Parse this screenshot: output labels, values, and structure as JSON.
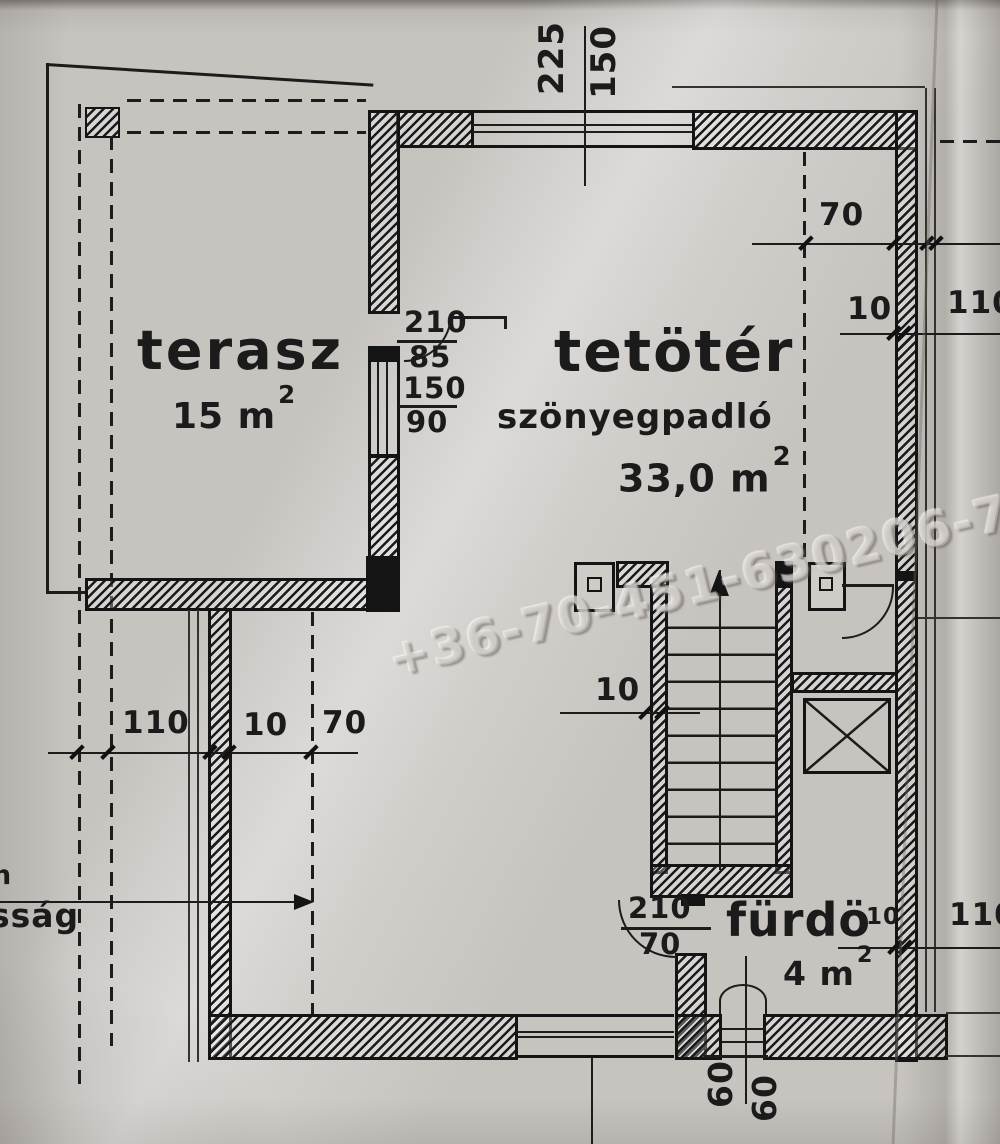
{
  "watermark": {
    "text": "+36-70-451-630206-70-525-3"
  },
  "rooms": {
    "terasz": {
      "name": "terasz",
      "area_value": "15 m",
      "area_sup": "2"
    },
    "tetoter": {
      "name": "tetötér",
      "floor_note": "szönyegpadló",
      "area_value": "33,0 m",
      "area_sup": "2"
    },
    "furdo": {
      "name": "fürdö",
      "area_value": "4 m",
      "area_sup": "2"
    }
  },
  "dims": {
    "top_window_w": "225",
    "top_window_h": "150",
    "terasz_door_h": "210",
    "terasz_door_w": "85",
    "terasz_window_h": "150",
    "terasz_window_w": "90",
    "right_offset": "70",
    "right_wall": "10",
    "right_eaves": "110",
    "left_eaves": "110",
    "left_wall": "10",
    "left_offset": "70",
    "stair_wall": "10",
    "furdo_door_h": "210",
    "furdo_door_w": "70",
    "furdo_wall": "10",
    "furdo_eaves": "110",
    "basin_left": "60",
    "basin_right": "60"
  },
  "fragments": {
    "left_edge_upper": "n",
    "left_edge_lower": "sság"
  }
}
